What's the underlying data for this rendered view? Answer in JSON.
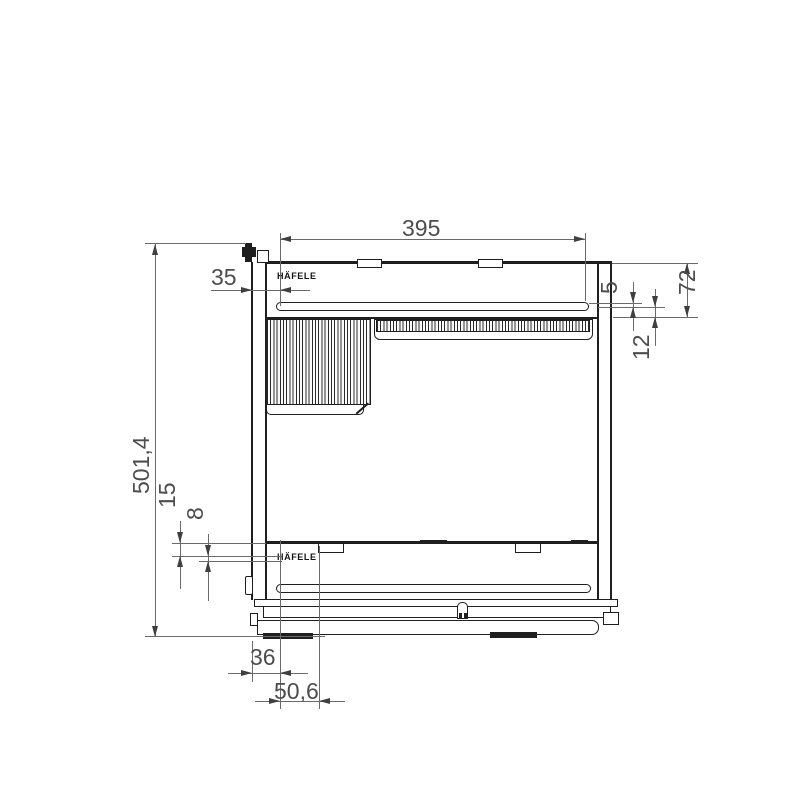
{
  "drawing": {
    "brand": "HÄFELE",
    "dims": {
      "width_top": "395",
      "front_offset_35": "35",
      "clearance_5": "5",
      "height_72": "72",
      "depth_12": "12",
      "total_height": "501,4",
      "offset_15": "15",
      "offset_8": "8",
      "offset_36": "36",
      "offset_50_6": "50,6"
    }
  }
}
